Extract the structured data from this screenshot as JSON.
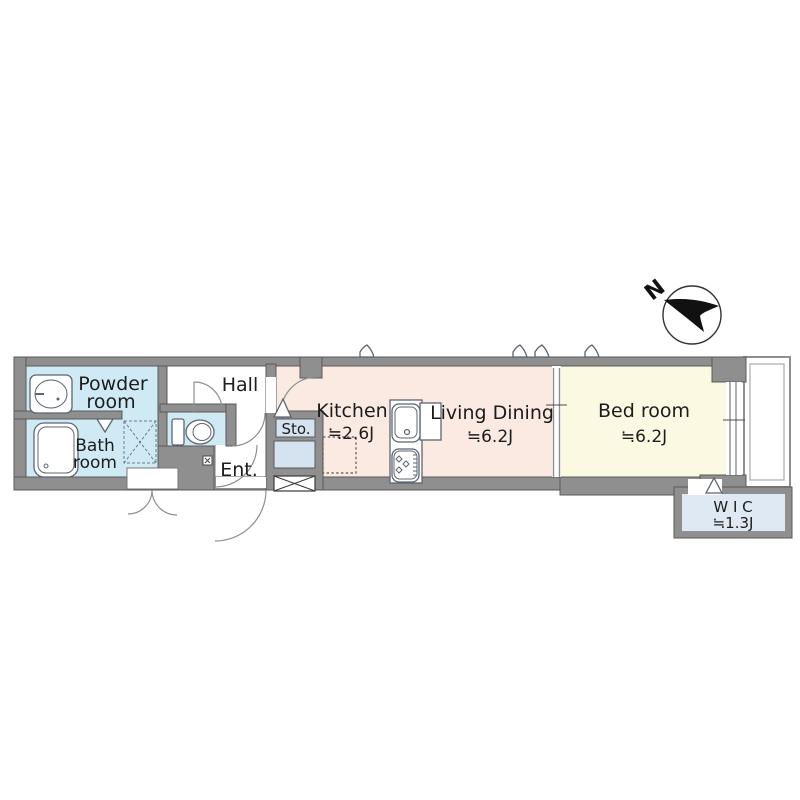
{
  "compass": {
    "north_label": "N"
  },
  "rooms": {
    "powder": {
      "line1": "Powder",
      "line2": "room"
    },
    "bath": {
      "line1": "Bath",
      "line2": "room"
    },
    "hall": {
      "label": "Hall"
    },
    "storage": {
      "label": "Sto."
    },
    "entrance": {
      "label": "Ent."
    },
    "kitchen": {
      "label": "Kitchen",
      "size": "≒2.6J"
    },
    "living_dining": {
      "label": "Living Dining",
      "size": "≒6.2J"
    },
    "bedroom": {
      "label": "Bed room",
      "size": "≒6.2J"
    },
    "wic": {
      "label": "W I C",
      "size": "≒1.3J"
    }
  },
  "colors": {
    "wall": "#8f8f8f",
    "wallStroke": "#5a5a5a",
    "wet": "#cfeaf5",
    "ldk": "#fbeae2",
    "bedroom": "#fbf9e2",
    "wic": "#dfe9f3",
    "box": "#d5e3f0",
    "text": "#1c1c1c"
  }
}
